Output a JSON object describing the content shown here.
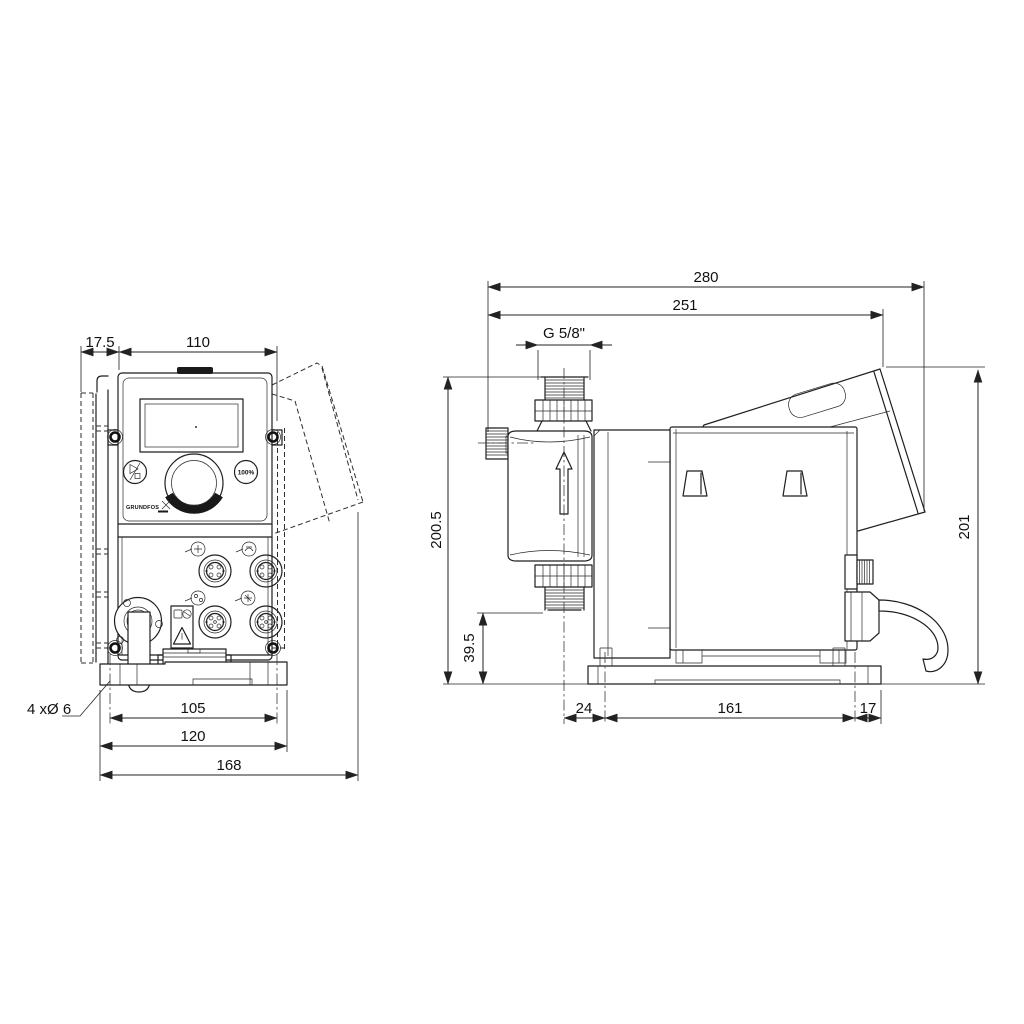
{
  "front_view": {
    "dim_wall_offset": "17.5",
    "dim_panel_width": "110",
    "dim_hole_span": "105",
    "dim_plate_width": "120",
    "dim_overall_depth": "168",
    "mounting_holes_label": "4 xØ 6",
    "button_100_label": "100%",
    "logo_text": "GRUNDFOS"
  },
  "side_view": {
    "dim_overall_length": "280",
    "dim_to_panel": "251",
    "thread_label": "G 5/8\"",
    "dim_valve_height": "200.5",
    "dim_port_height": "39.5",
    "dim_overall_height": "201",
    "dim_cl_to_plate": "24",
    "dim_hole_spacing": "161",
    "dim_plate_edge": "17"
  },
  "icons": {
    "flow-arrow-icon": "↑ hollow up arrow (flow direction)",
    "start-stop-icon": "▷ / □ run-stop glyph",
    "warning-icon": "△ warning triangle label",
    "connector-socket-icon": "round M12 plug socket",
    "io-mini-icon": "small circular I/O pictogram",
    "grundfos-logo": "GRUNDFOS wordmark",
    "air-vent-knob-icon": "knurled vent knob",
    "cable-icon": "power cable"
  },
  "colors": {
    "line": "#1f1f1f",
    "background": "#ffffff"
  }
}
